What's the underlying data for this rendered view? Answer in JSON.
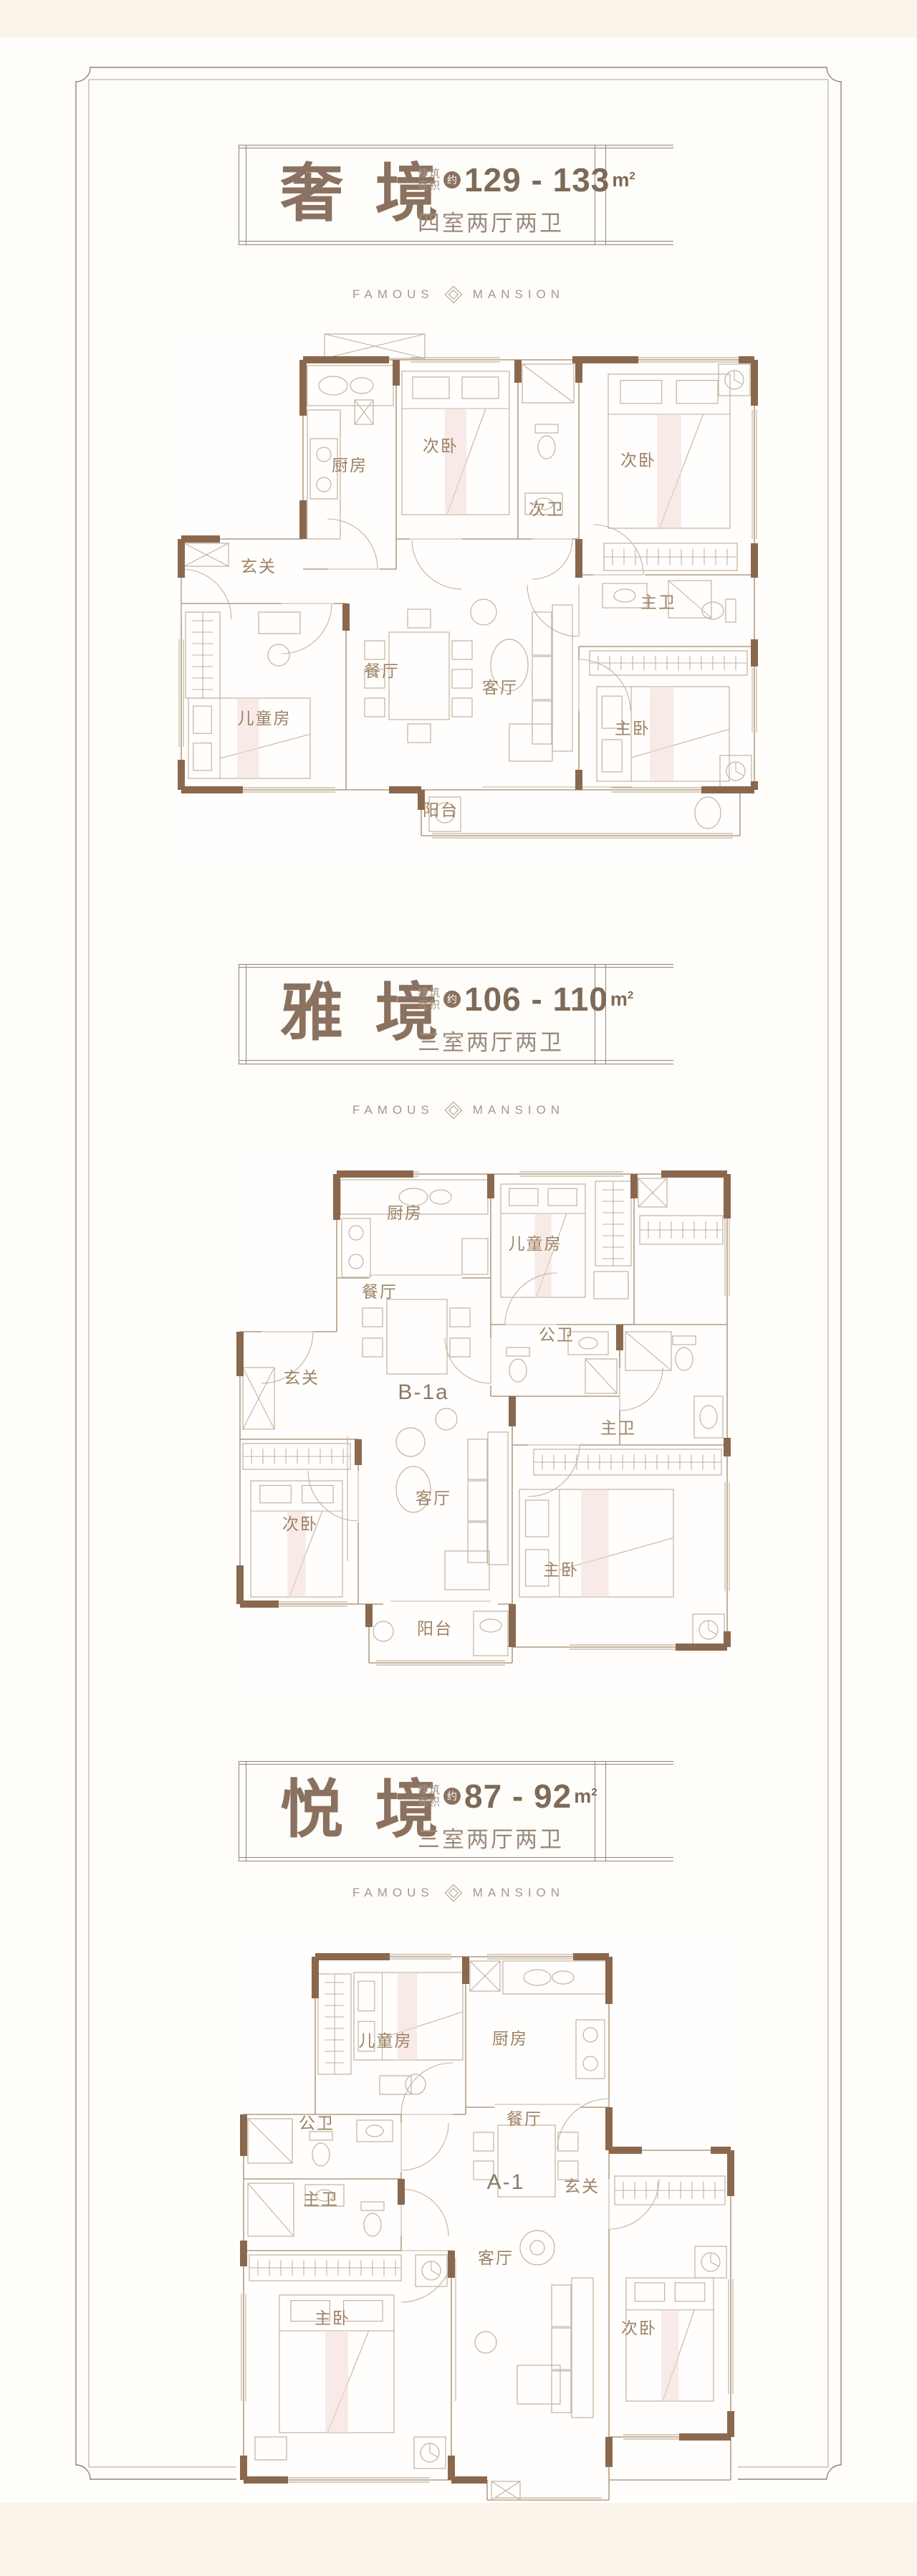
{
  "brand": {
    "left": "FAMOUS",
    "right": "MANSION",
    "diamond_icon": "nested-diamond"
  },
  "labels": {
    "area_prefix_1": "建筑",
    "area_prefix_2": "面积",
    "approx": "约",
    "unit": "m",
    "unit_sup": "2"
  },
  "colors": {
    "accent": "#8a7160",
    "number": "#7e6a58",
    "muted": "#9a897b",
    "small": "#a29283",
    "divider_text": "#a19990",
    "frame_outer": "#8e867c",
    "frame_inner": "#aaa296",
    "wall": "#8a684e",
    "line": "#b49c82",
    "furniture": "#c2b2a0",
    "pink": "#f3d9d5",
    "room_label": "#9d8164",
    "code_label": "#8b7a68",
    "band": "#faf3ea",
    "paper": "#fffdf9"
  },
  "sections": [
    {
      "title": "奢 境",
      "area": "129 - 133",
      "layout": "四室两厅两卫",
      "plan_code": "",
      "rooms": [
        {
          "key": "entry",
          "label": "玄关"
        },
        {
          "key": "kitchen",
          "label": "厨房"
        },
        {
          "key": "bed2a",
          "label": "次卧"
        },
        {
          "key": "bath2",
          "label": "次卫"
        },
        {
          "key": "bed2b",
          "label": "次卧"
        },
        {
          "key": "bathM",
          "label": "主卫"
        },
        {
          "key": "bedM",
          "label": "主卧"
        },
        {
          "key": "kid",
          "label": "儿童房"
        },
        {
          "key": "dining",
          "label": "餐厅"
        },
        {
          "key": "living",
          "label": "客厅"
        },
        {
          "key": "balcony",
          "label": "阳台"
        }
      ]
    },
    {
      "title": "雅 境",
      "area": "106 - 110",
      "layout": "三室两厅两卫",
      "plan_code": "B-1a",
      "rooms": [
        {
          "key": "kitchen",
          "label": "厨房"
        },
        {
          "key": "kid",
          "label": "儿童房"
        },
        {
          "key": "dining",
          "label": "餐厅"
        },
        {
          "key": "bath2",
          "label": "公卫"
        },
        {
          "key": "entry",
          "label": "玄关"
        },
        {
          "key": "bed2",
          "label": "次卧"
        },
        {
          "key": "living",
          "label": "客厅"
        },
        {
          "key": "bathM",
          "label": "主卫"
        },
        {
          "key": "bedM",
          "label": "主卧"
        },
        {
          "key": "balcony",
          "label": "阳台"
        }
      ]
    },
    {
      "title": "悦 境",
      "area": "87 - 92",
      "layout": "三室两厅两卫",
      "plan_code": "A-1",
      "rooms": [
        {
          "key": "kid",
          "label": "儿童房"
        },
        {
          "key": "kitchen",
          "label": "厨房"
        },
        {
          "key": "bath2",
          "label": "公卫"
        },
        {
          "key": "bathM",
          "label": "主卫"
        },
        {
          "key": "dining",
          "label": "餐厅"
        },
        {
          "key": "entry",
          "label": "玄关"
        },
        {
          "key": "bedM",
          "label": "主卧"
        },
        {
          "key": "living",
          "label": "客厅"
        },
        {
          "key": "bed2",
          "label": "次卧"
        }
      ]
    }
  ]
}
